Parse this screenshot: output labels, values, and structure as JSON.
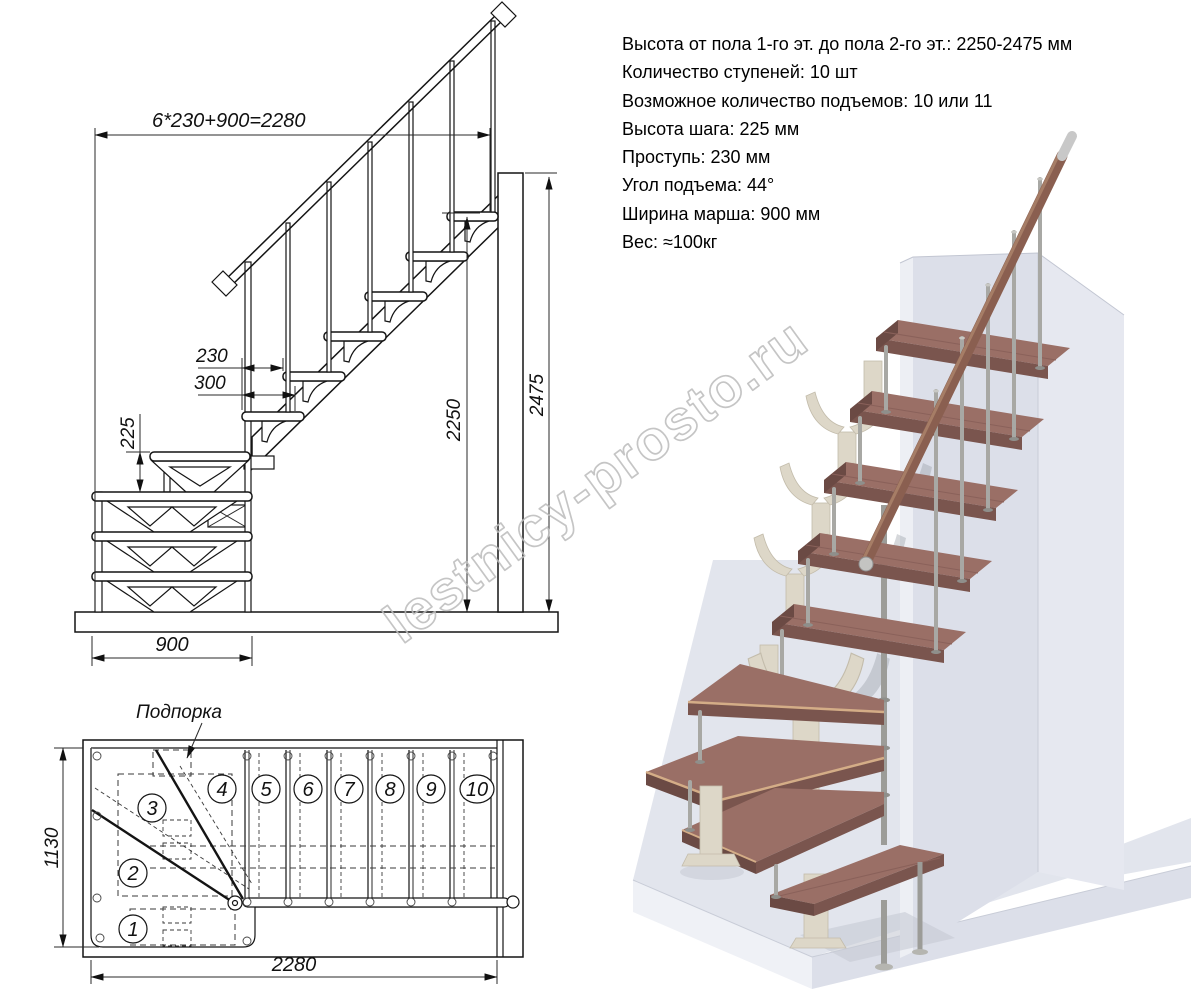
{
  "specs": {
    "lines": [
      "Высота от пола 1-го эт. до пола 2-го эт.: 2250-2475 мм",
      "Количество ступеней: 10 шт",
      "Возможное количество подъемов: 10 или 11",
      "Высота шага: 225 мм",
      "Проступь: 230 мм",
      "Угол подъема: 44°",
      "Ширина марша: 900 мм",
      "Вес: ≈100кг"
    ]
  },
  "elevation": {
    "dim_total_run": "6*230+900=2280",
    "dim_run": "230",
    "dim_tread_depth": "300",
    "dim_riser": "225",
    "dim_clear_height": "2250",
    "dim_total_height": "2475",
    "dim_march_width": "900"
  },
  "plan": {
    "support_label": "Подпорка",
    "dim_depth": "1130",
    "dim_length": "2280",
    "steps": [
      "1",
      "2",
      "3",
      "4",
      "5",
      "6",
      "7",
      "8",
      "9",
      "10"
    ]
  },
  "watermark": "lestnicy-prosto.ru",
  "colors": {
    "drawing_line": "#141414",
    "tread_wood": "#9a6f66",
    "tread_front": "#7a554e",
    "tread_edge_light": "#d4ad87",
    "handrail_wood": "#8a5f50",
    "metal": "#a8a8a4",
    "bracket_cream": "#ddd7c8",
    "wall_front": "#dcdfe9",
    "wall_side": "#e6e8f0",
    "floor": "#e2e5ed",
    "watermark_gray": "#bcbcbc"
  }
}
